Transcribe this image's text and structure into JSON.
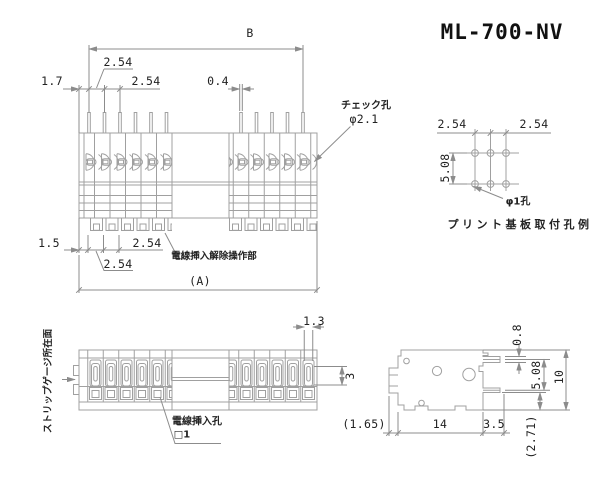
{
  "title": "ML-700-NV",
  "top_view": {
    "dim_b": "B",
    "dim_pitch_top_1": "2.54",
    "dim_pitch_top_2": "2.54",
    "dim_left_margin": "1.7",
    "dim_pin_width": "0.4",
    "check_hole_label": "チェック孔",
    "check_hole_dia": "φ2.1",
    "dim_bottom_margin": "1.5",
    "dim_pitch_bottom_1": "2.54",
    "dim_pitch_bottom_2": "2.54",
    "release_label": "電線挿入解除操作部",
    "dim_overall": "(A)"
  },
  "hole_pattern": {
    "dim_pitch_left": "2.54",
    "dim_pitch_right": "2.54",
    "dim_row_pitch": "5.08",
    "hole_label": "φ1孔",
    "caption": "プリント基板取付孔例"
  },
  "front_view": {
    "strip_gauge_label": "ストリップゲージ所在面",
    "dim_slot_width": "1.3",
    "dim_slot_height": "3",
    "wire_hole_label": "電線挿入孔",
    "wire_hole_size": "□1"
  },
  "side_view": {
    "dim_pin_thickness": "0.8",
    "dim_pin_pitch": "5.08",
    "dim_height": "10",
    "dim_depth": "14",
    "dim_pin_length": "3.5",
    "dim_ref_bottom": "(2.71)",
    "dim_ref_left": "(1.65)"
  }
}
